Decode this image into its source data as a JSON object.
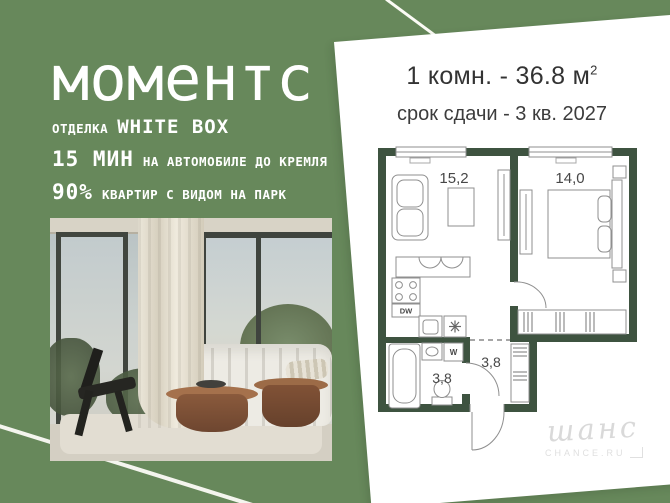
{
  "brand": {
    "name": "моментс",
    "finish_label": "ОТДЕЛКА",
    "finish_value": "WHITE BOX",
    "features": [
      {
        "value": "15 МИН",
        "label": "НА АВТОМОБИЛЕ ДО КРЕМЛЯ"
      },
      {
        "value": "90%",
        "label": "КВАРТИР С ВИДОМ НА ПАРК"
      }
    ]
  },
  "card": {
    "title_main": "1 комн. - 36.8 м",
    "title_sup": "2",
    "subtitle": "срок сдачи - 3 кв. 2027"
  },
  "floorplan": {
    "rooms": [
      {
        "name": "living-kitchen",
        "area": "15,2"
      },
      {
        "name": "bedroom",
        "area": "14,0"
      },
      {
        "name": "hallway",
        "area": "3,8"
      },
      {
        "name": "bathroom",
        "area": "3,8"
      }
    ],
    "labels": {
      "dishwasher": "DW",
      "washer": "W"
    }
  },
  "watermark": {
    "script": "шанс",
    "caption": "CHANCE.RU"
  },
  "colors": {
    "background": "#67885B",
    "wall": "#3E5340",
    "card": "#FFFFFF",
    "text_light": "#FFFFFF",
    "text_dark": "#333333"
  }
}
